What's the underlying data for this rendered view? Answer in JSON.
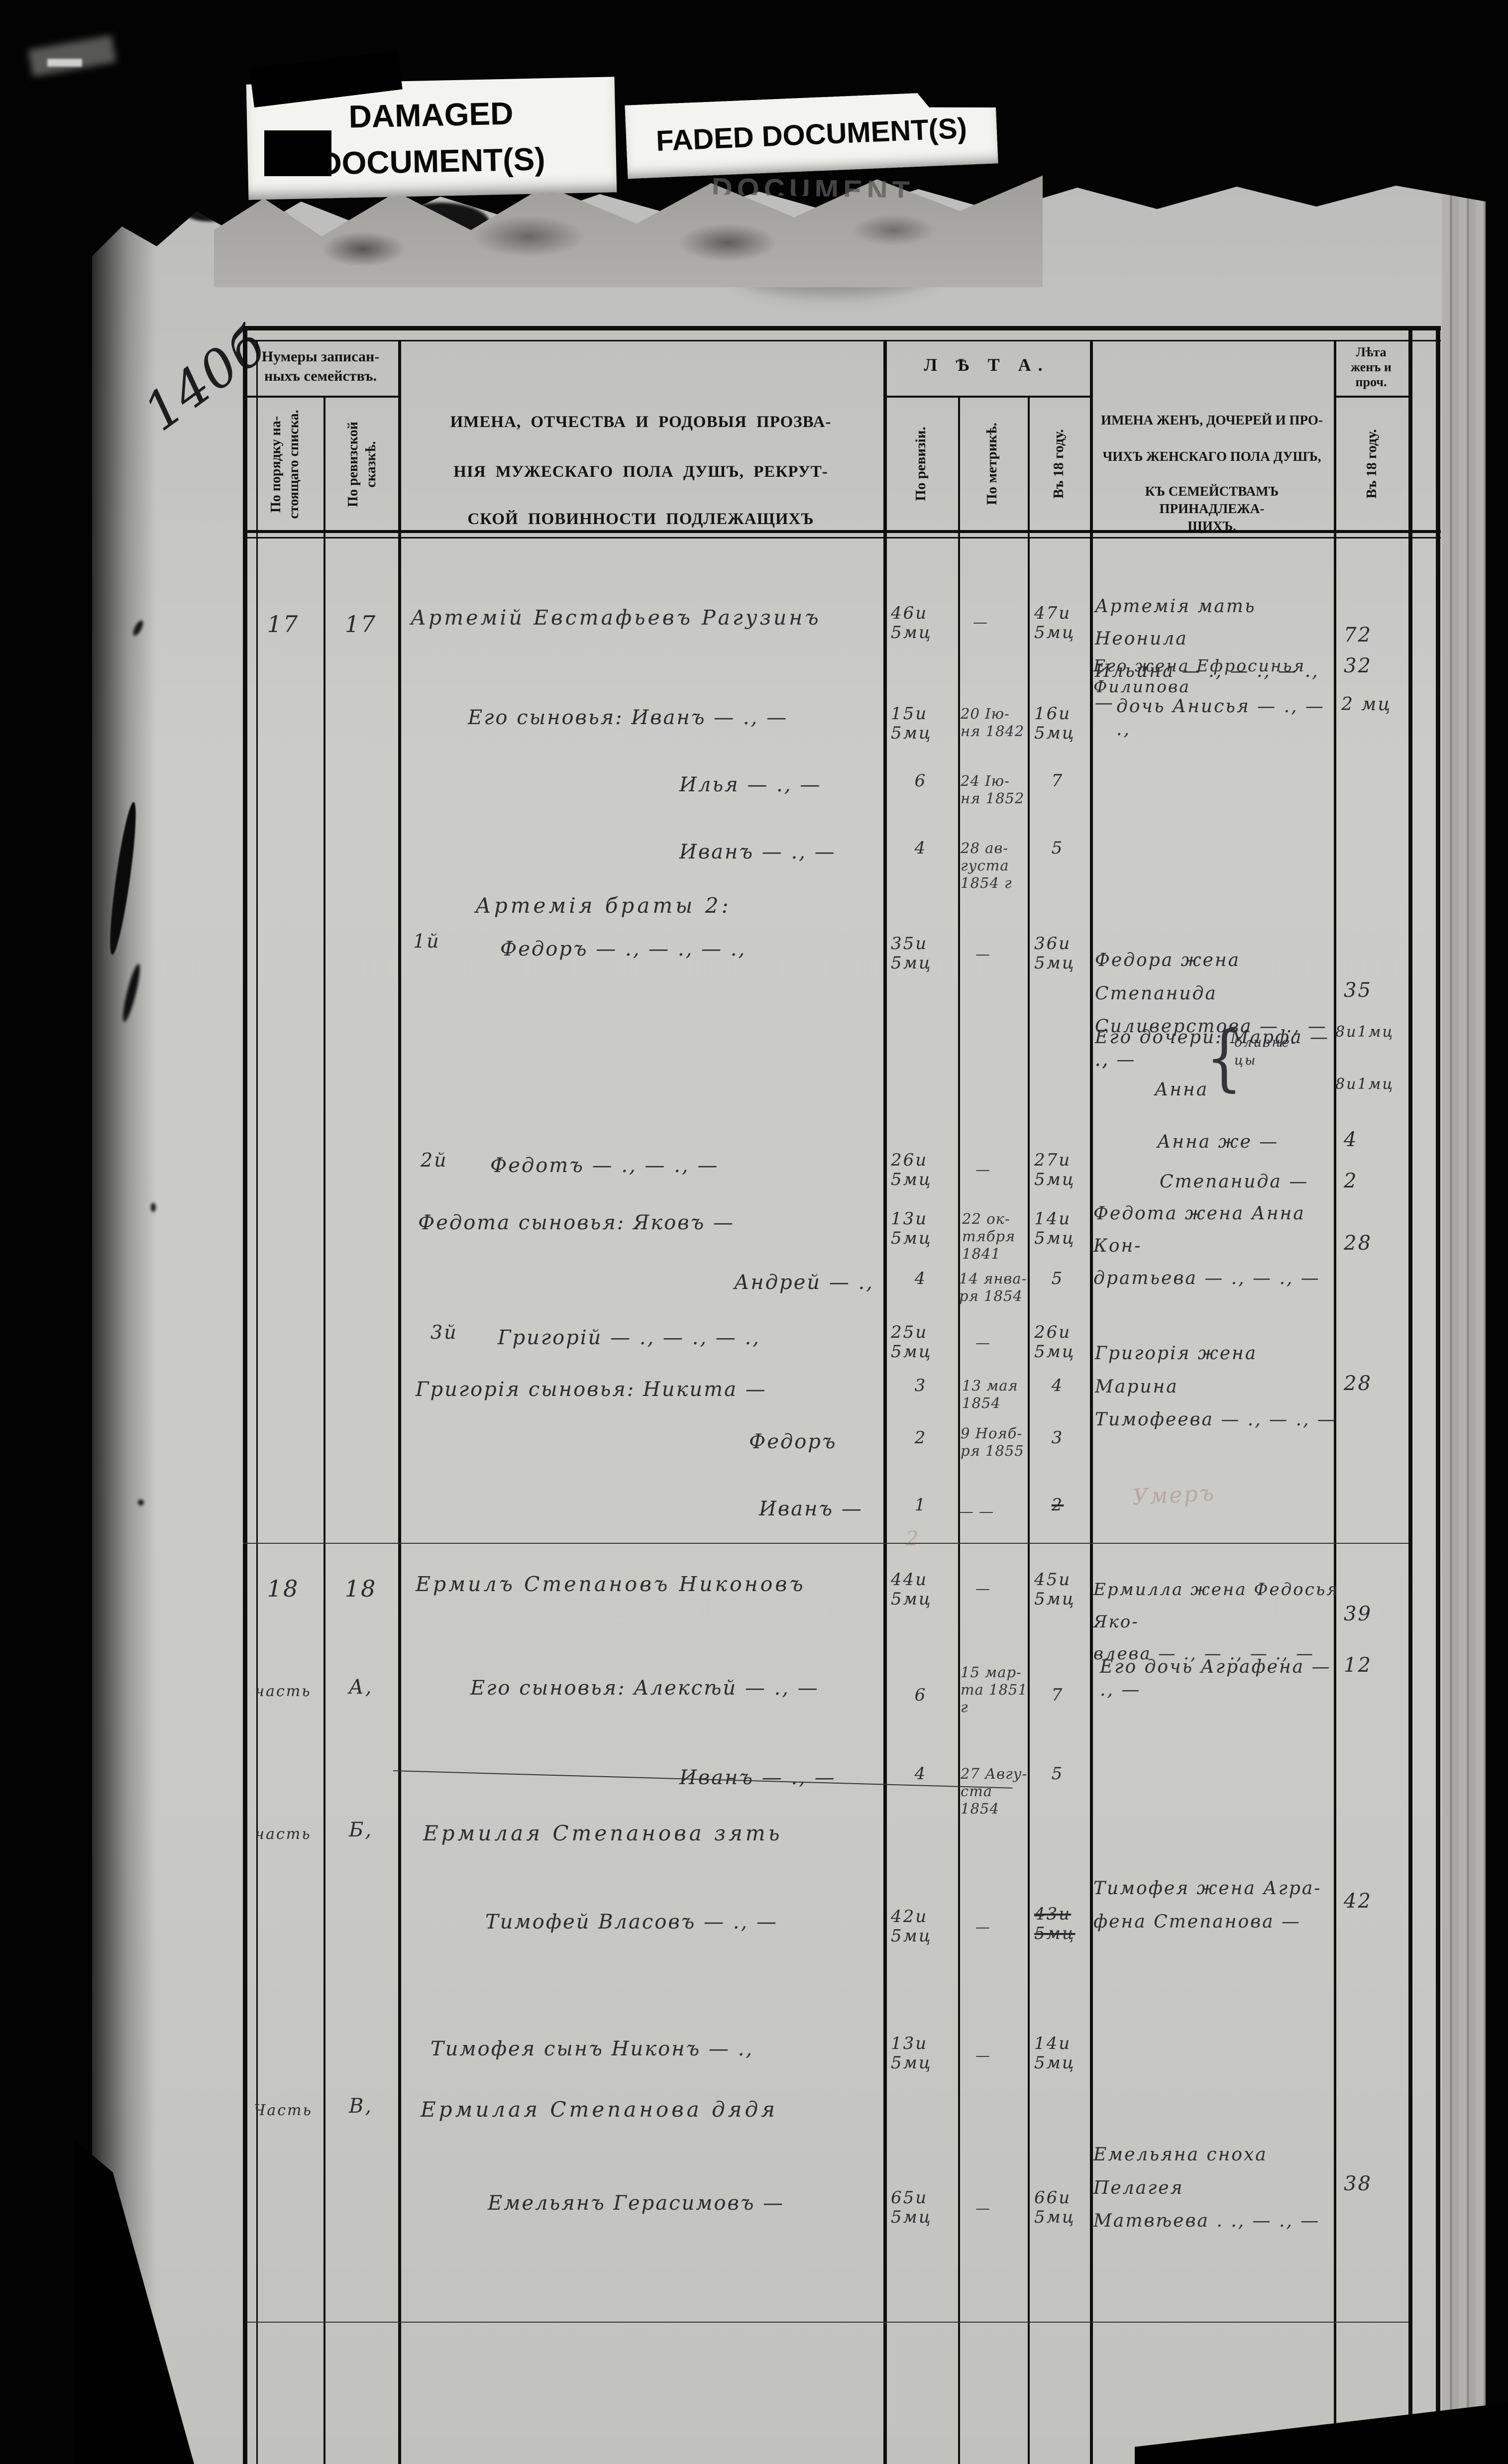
{
  "scan_labels": {
    "damaged": "DAMAGED\nDOCUMENT(S)",
    "faded": "FADED DOCUMENT(S)",
    "ghost_remnant": "DOCUMENT"
  },
  "margin": {
    "page_number": "140б"
  },
  "header": {
    "numbers_group": "Нумеры записан-\nныхъ семействъ.",
    "col_order": "По порядку на-\nстоящаго списка.",
    "col_revision_tale": "По ревизской\nсказкѣ.",
    "male_title": [
      "ИМЕНА, ОТЧЕСТВА И РОДОВЫЯ ПРОЗВА-",
      "НІЯ МУЖЕСКАГО ПОЛА ДУШЪ, РЕКРУТ-",
      "СКОЙ ПОВИННОСТИ ПОДЛЕЖАЩИХЪ"
    ],
    "years_group": "Л Ѣ Т А.",
    "col_by_revision": "По ревизіи.",
    "col_by_metrics": "По метрикѣ.",
    "col_in_18": "Въ 18      году.",
    "female_title": [
      "ИМЕНА ЖЕНЪ, ДОЧЕРЕЙ И ПРО-",
      "ЧИХЪ ЖЕНСКАГО ПОЛА ДУШЪ,",
      "КЪ СЕМЕЙСТВАМЪ ПРИНАДЛЕЖА-",
      "ЩИХЪ."
    ],
    "female_years_group": "Лѣта\nженъ и\nпроч.",
    "female_in_18": "Въ 18      году."
  },
  "men": [
    {
      "n1": "17",
      "n2": "17",
      "text": "Артемій Евстафьевъ Рагузинъ",
      "rev": "46и\n5мц",
      "metric": "—",
      "in18": "47и\n5мц"
    },
    {
      "text": "Его сыновья: Иванъ — ., —",
      "rev": "15и\n5мц",
      "metric": "20 Ію-\nня 1842",
      "in18": "16и\n5мц"
    },
    {
      "text": "Илья — ., —",
      "rev": "6",
      "metric": "24 Ію-\nня 1852",
      "in18": "7"
    },
    {
      "text": "Иванъ — ., —",
      "rev": "4",
      "metric": "28 ав-\nгуста\n1854 г",
      "in18": "5"
    },
    {
      "text": "Артемія браты 2:"
    },
    {
      "ord": "1й",
      "text": "Федоръ — ., — ., — .,",
      "rev": "35и\n5мц",
      "metric": "—",
      "in18": "36и\n5мц"
    },
    {
      "ord": "2й",
      "text": "Федотъ — ., — ., —",
      "rev": "26и\n5мц",
      "metric": "—",
      "in18": "27и\n5мц"
    },
    {
      "text": "Федота сыновья: Яковъ —",
      "rev": "13и\n5мц",
      "metric": "22 ок-\nтября\n1841",
      "in18": "14и\n5мц"
    },
    {
      "text": "Андрей — .,",
      "rev": "4",
      "metric": "14 янва-\nря 1854",
      "in18": "5"
    },
    {
      "ord": "3й",
      "text": "Григорій — ., — ., — .,",
      "rev": "25и\n5мц",
      "metric": "—",
      "in18": "26и\n5мц"
    },
    {
      "text": "Григорія сыновья: Никита —",
      "rev": "3",
      "metric": "13 мая\n1854",
      "in18": "4"
    },
    {
      "text": "Федоръ",
      "rev": "2",
      "metric": "9 Нояб-\nря 1855",
      "in18": "3"
    },
    {
      "text": "Иванъ —",
      "rev": "1",
      "metric": "— —",
      "in18": "2"
    },
    {
      "n1": "18",
      "n2": "18",
      "text": "Ермилъ Степановъ Никоновъ",
      "rev": "44и\n5мц",
      "metric": "—",
      "in18": "45и\n5мц"
    },
    {
      "n1": "часть",
      "n2": "А,",
      "text": "Его сыновья: Алексѣй — ., —",
      "rev": "6",
      "metric": "15 мар-\nта 1851 г",
      "in18": "7"
    },
    {
      "text": "Иванъ — ., —",
      "rev": "4",
      "metric": "27 Авгу-\nста\n1854",
      "in18": "5"
    },
    {
      "n1": "часть",
      "n2": "Б,",
      "text": "Ермилая Степанова зять"
    },
    {
      "text": "Тимофей Власовъ — ., —",
      "rev": "42и\n5мц",
      "metric": "—",
      "in18": "43и\n5мц"
    },
    {
      "text": "Тимофея сынъ Никонъ — .,",
      "rev": "13и\n5мц",
      "metric": "—",
      "in18": "14и\n5мц"
    },
    {
      "n1": "Часть",
      "n2": "В,",
      "text": "Ермилая Степанова дядя"
    },
    {
      "text": "Емельянъ Герасимовъ —",
      "rev": "65и\n5мц",
      "metric": "—",
      "in18": "66и\n5мц"
    }
  ],
  "women": [
    {
      "text": "Артемія мать Неонила\nИльина — ., — ., — ., —",
      "age": "72"
    },
    {
      "text": "Его жена Ефросинья Филипова",
      "age": "32"
    },
    {
      "text": "дочь Анисья — ., — .,",
      "age": "2 мц"
    },
    {
      "text": "Федора жена Степанида\nСиливерстова — ., — ., —",
      "age": "35"
    },
    {
      "text": "Его дочери: Марфа — .,",
      "age": "8и1мц"
    },
    {
      "text": "Анна",
      "age": "8и1мц"
    },
    {
      "text": "Анна же —",
      "age": "4"
    },
    {
      "text": "Степанида —",
      "age": "2"
    },
    {
      "text": "Федота жена Анна Кон-\nдратьева — ., — ., —",
      "age": "28"
    },
    {
      "text": "Григорія жена Марина\nТимофеева — ., — ., —",
      "age": "28"
    },
    {
      "text": "Ермилла жена Федосья Яко-\nвлева — ., — ., — ., —",
      "age": "39"
    },
    {
      "text": "Его дочь Аграфена — ., —",
      "age": "12"
    },
    {
      "text": "Тимофея жена Агра-\nфена Степанова —",
      "age": "42"
    },
    {
      "text": "Емельяна сноха Пелагея\nМатвѣева . ., — ., —",
      "age": "38"
    }
  ],
  "notes": {
    "twins_brace": "{",
    "twins": "близне-\nцы",
    "ghost_died": "Умеръ",
    "ghost_two": "2"
  }
}
